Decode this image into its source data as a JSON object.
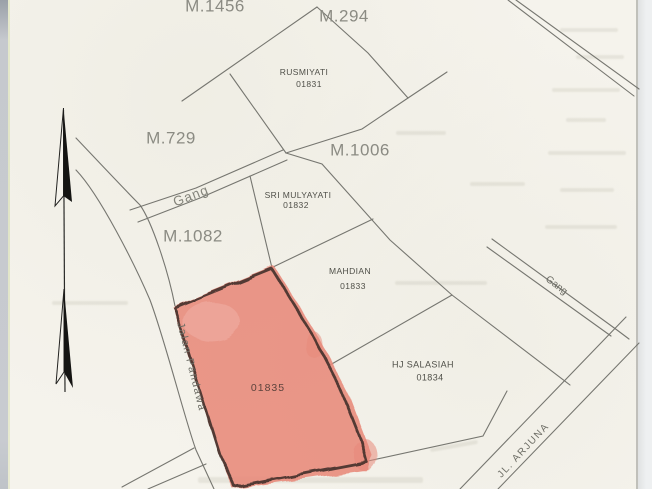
{
  "document": {
    "type_label": "cadastral parcel map (scanned)",
    "colors": {
      "paper": "#f5f3ec",
      "map_line": "#767670",
      "highlight_fill": "#e8897a",
      "highlight_outline": "#42302b"
    },
    "icons": {
      "north_arrow": "north-arrow"
    }
  },
  "parcels": {
    "m1456": "M.1456",
    "m294": "M.294",
    "m729": "M.729",
    "m1006": "M.1006",
    "m1082": "M.1082"
  },
  "owners": {
    "rusmiyati": {
      "name": "RUSMIYATI",
      "number": "01831"
    },
    "sri_mulyayati": {
      "name": "SRI MULYAYATI",
      "number": "01832"
    },
    "mahdian": {
      "name": "MAHDIAN",
      "number": "01833"
    },
    "hj_salasiah": {
      "name": "HJ SALASIAH",
      "number": "01834"
    }
  },
  "highlight": {
    "number": "01835"
  },
  "roads": {
    "gang_left": "Gang",
    "gang_right": "Gang",
    "jalan_pandawa": "Jalan Pandawa",
    "jl_arjuna": "JL. ARJUNA"
  }
}
